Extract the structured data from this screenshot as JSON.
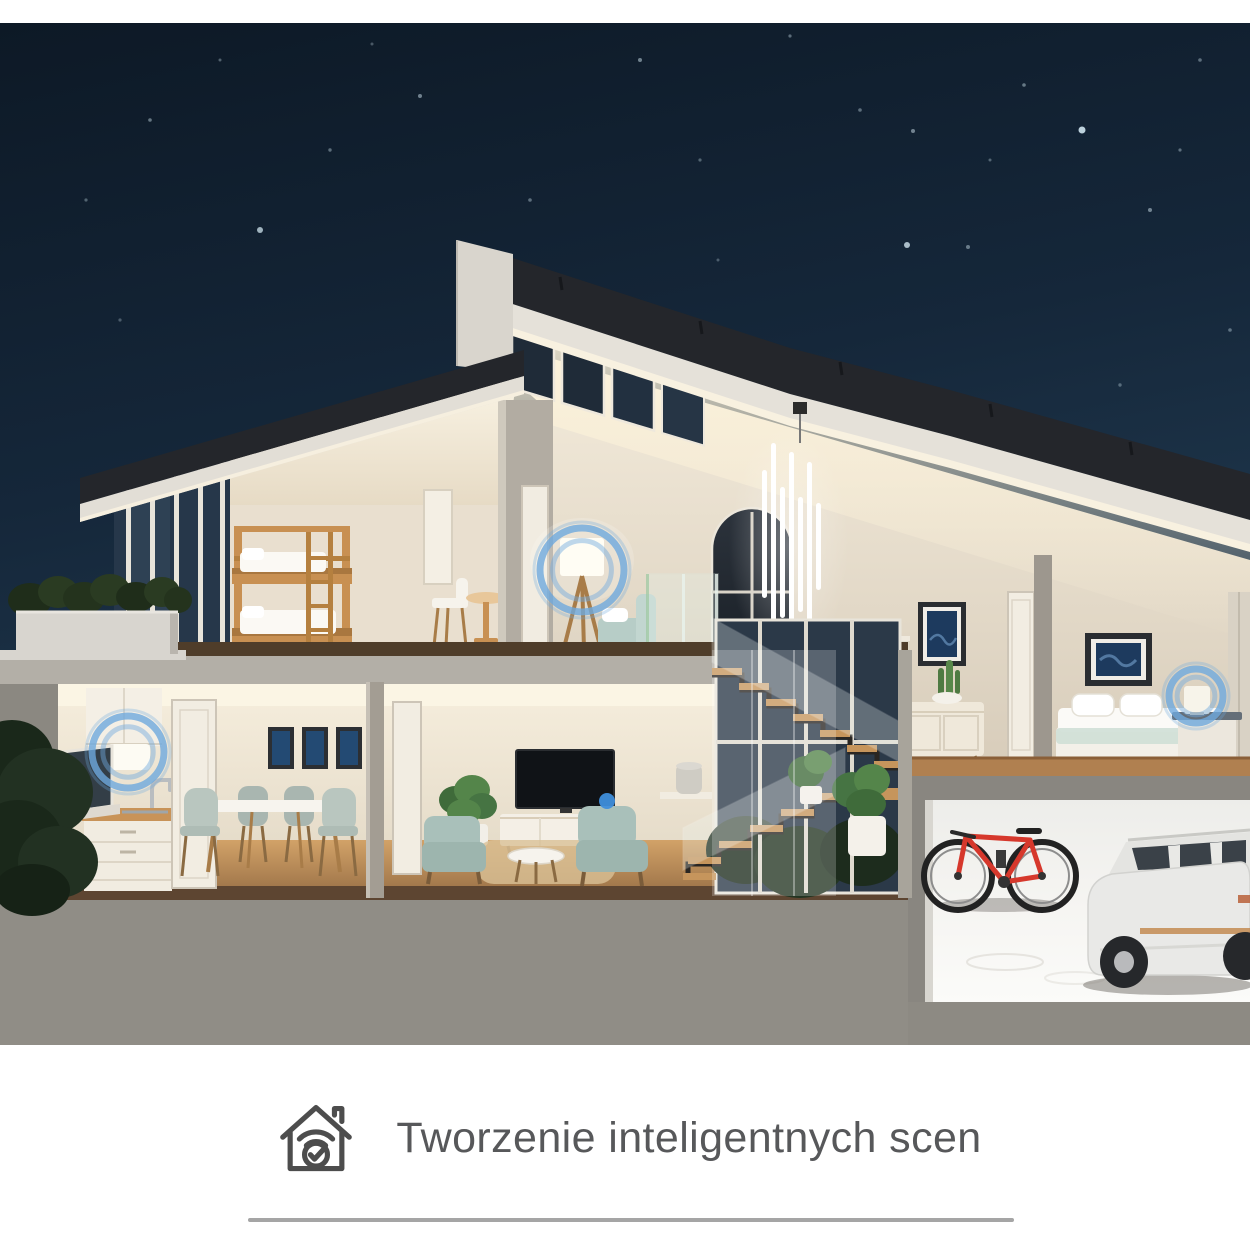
{
  "page": {
    "top_band_color": "#ffffff",
    "background": "#ffffff"
  },
  "caption": {
    "icon": "smart-home-wifi-check-icon",
    "label": "Tworzenie inteligentnych scen",
    "color": "#57585a"
  },
  "divider": {
    "color": "#a5a5a5"
  },
  "theme": {
    "sky_top": "#0d1926",
    "sky_bottom": "#27455e",
    "star_color": "#cfe4ee",
    "roof_dark": "#24262b",
    "fascia": "#e5e1d9",
    "wall_warm": "#efe7d8",
    "wall_lit": "#f9f3e3",
    "exterior_gray": "#8f8c85",
    "wood": "#c89052",
    "wood_dark": "#54402c",
    "teal_furniture": "#a9c0ba",
    "garage_white": "#f3f2ef",
    "bike_red": "#d6382c",
    "car_white": "#e9e9e7",
    "accent_blue": "#6ea9dd",
    "accent_blue_dot": "#3f8edb"
  },
  "scene": {
    "description": "Night-time cutaway 3D render of a two-storey smart home with garage; blue rings highlight smart lamps and devices",
    "stars": [
      [
        1082,
        130,
        3.5,
        0.9
      ],
      [
        907,
        245,
        3,
        0.8
      ],
      [
        968,
        247,
        2,
        0.45
      ],
      [
        913,
        131,
        2,
        0.5
      ],
      [
        260,
        230,
        3,
        0.75
      ],
      [
        420,
        96,
        2,
        0.5
      ],
      [
        530,
        200,
        1.8,
        0.4
      ],
      [
        640,
        60,
        2,
        0.5
      ],
      [
        700,
        160,
        1.6,
        0.35
      ],
      [
        790,
        36,
        1.6,
        0.4
      ],
      [
        860,
        110,
        1.8,
        0.4
      ],
      [
        1024,
        85,
        1.8,
        0.45
      ],
      [
        1150,
        210,
        2,
        0.5
      ],
      [
        1200,
        60,
        1.8,
        0.4
      ],
      [
        480,
        280,
        1.6,
        0.35
      ],
      [
        330,
        150,
        1.7,
        0.4
      ],
      [
        150,
        120,
        1.8,
        0.45
      ],
      [
        120,
        320,
        1.6,
        0.3
      ],
      [
        1230,
        330,
        1.8,
        0.4
      ],
      [
        718,
        260,
        1.5,
        0.3
      ],
      [
        1120,
        385,
        1.7,
        0.35
      ],
      [
        560,
        340,
        1.5,
        0.3
      ],
      [
        220,
        60,
        1.5,
        0.35
      ],
      [
        990,
        160,
        1.5,
        0.35
      ],
      [
        1180,
        150,
        1.6,
        0.4
      ],
      [
        372,
        44,
        1.5,
        0.3
      ],
      [
        86,
        200,
        1.6,
        0.35
      ]
    ],
    "smart_spots": [
      {
        "name": "smart-spot-kitchen-lamp",
        "x": 128,
        "y": 752,
        "r": 36,
        "style": "ring"
      },
      {
        "name": "smart-spot-landing-floor-lamp",
        "x": 582,
        "y": 570,
        "r": 42,
        "style": "ring"
      },
      {
        "name": "smart-spot-bedroom-lamp",
        "x": 1196,
        "y": 696,
        "r": 27,
        "style": "ring"
      },
      {
        "name": "smart-spot-living-room-device",
        "x": 607,
        "y": 801,
        "r": 8,
        "style": "dot"
      }
    ]
  }
}
